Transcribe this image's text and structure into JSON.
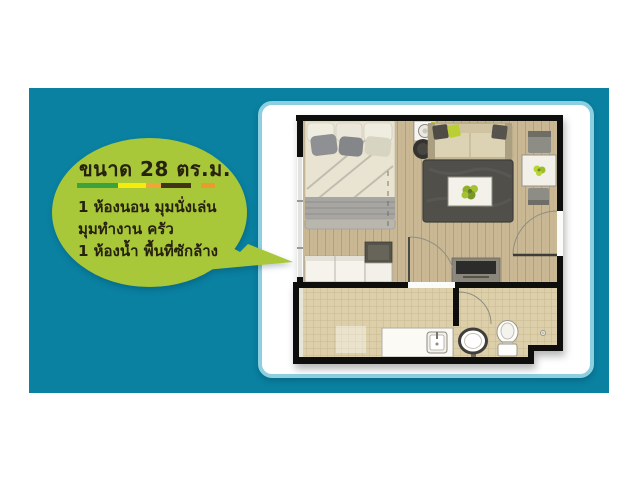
{
  "page": {
    "bg_color": "#ffffff"
  },
  "colors": {
    "panel_bg": "#0a81a1",
    "card_border": "#8ccfe1",
    "card_bg": "#ffffff",
    "bubble_bg": "#a8c739",
    "text_dark": "#27210f"
  },
  "bubble": {
    "title": "ขนาด 28 ตร.ม.",
    "stripe": [
      {
        "color": "#3ca33c",
        "width": 41
      },
      {
        "color": "#f6ec09",
        "width": 28
      },
      {
        "color": "#f0a636",
        "width": 15
      },
      {
        "color": "#403617",
        "width": 30
      },
      {
        "color": "transparent",
        "width": 10
      },
      {
        "color": "#ec9a2f",
        "width": 14
      }
    ],
    "lines": [
      "1 ห้องนอน มุมนั่งเล่น",
      "มุมทำงาน ครัว",
      "1 ห้องน้ำ พื้นที่ซักล้าง"
    ]
  },
  "floorplan": {
    "items": [
      "bed",
      "pillows",
      "blanket",
      "wardrobe",
      "storage-cabinet",
      "washing-machine",
      "stool",
      "sofa",
      "throw-pillows",
      "rug",
      "coffee-table",
      "potted-plant",
      "dining-table",
      "dining-chairs",
      "tv-console",
      "window",
      "entrance-door",
      "interior-door",
      "bathroom-door",
      "laundry-counter",
      "laundry-sink",
      "wash-basin",
      "toilet",
      "floor-drain"
    ]
  }
}
